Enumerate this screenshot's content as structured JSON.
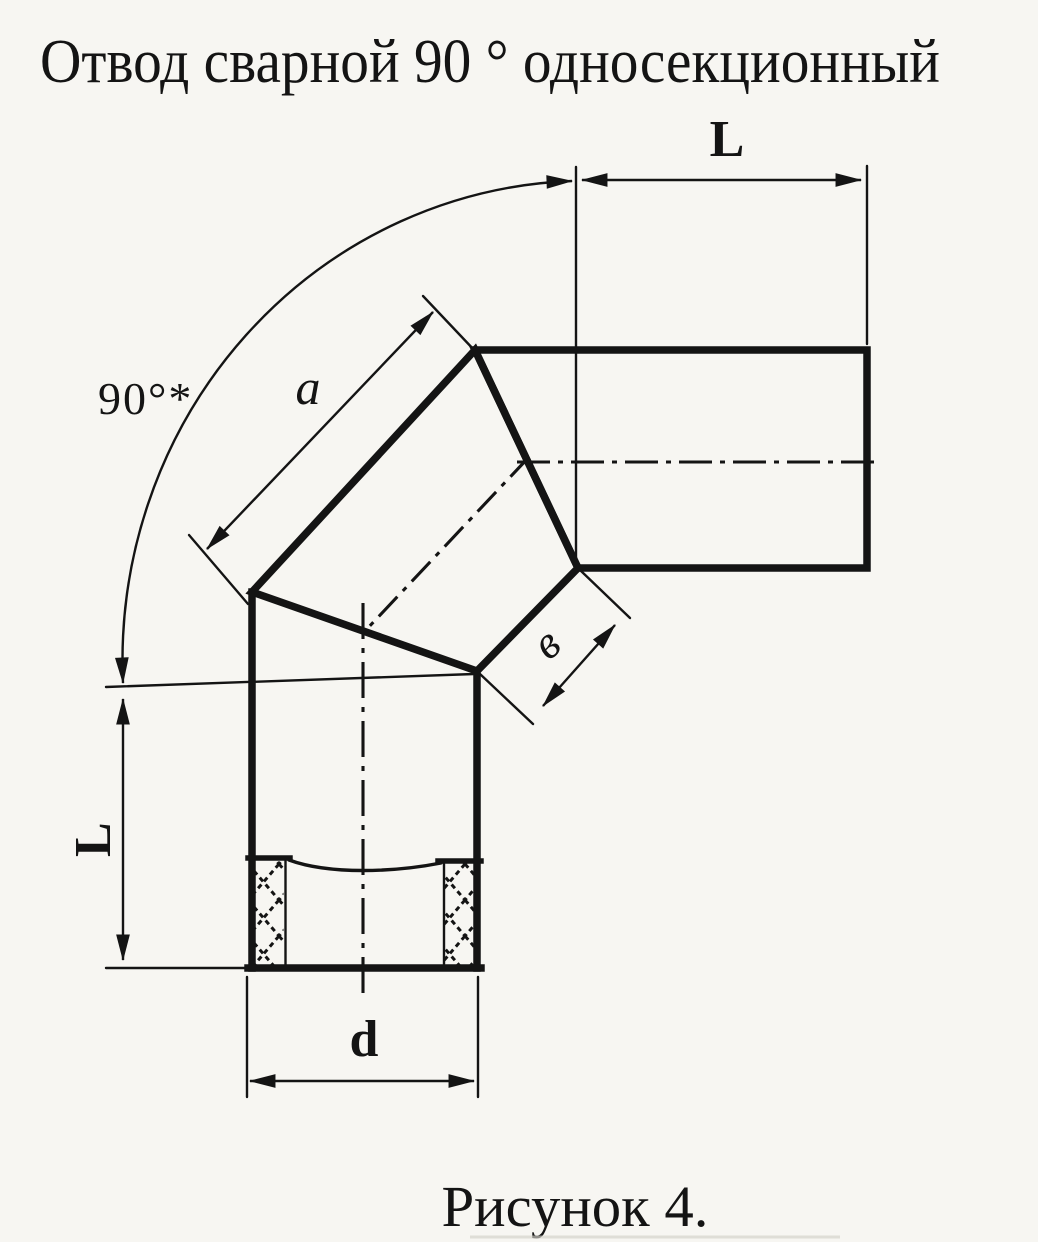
{
  "title": "Отвод сварной 90 ° односекционный",
  "caption": "Рисунок 4.",
  "dimensions": {
    "top_length": "L",
    "left_length": "L",
    "angle": "90°*",
    "section_long_side": "a",
    "section_short_side": "в",
    "diameter": "d"
  },
  "colors": {
    "ink": "#141414",
    "paper": "#f7f6f2"
  }
}
